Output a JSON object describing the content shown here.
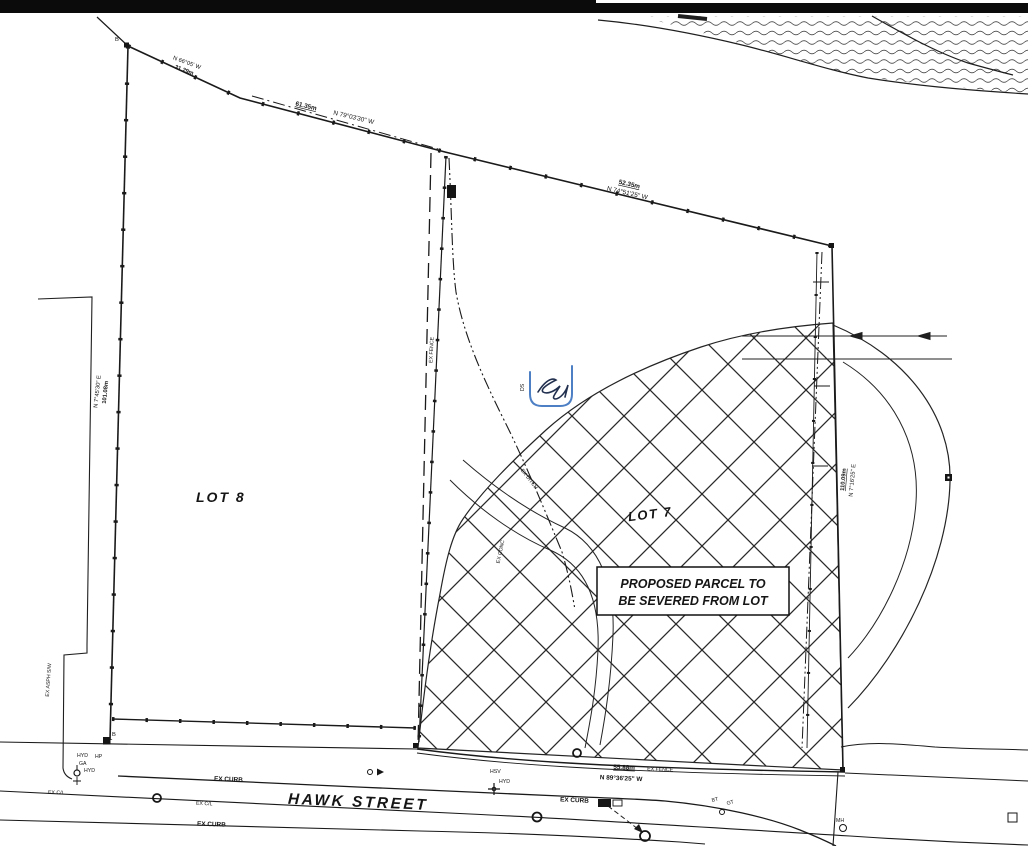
{
  "colors": {
    "ink": "#1b1b1b",
    "annotation_blue": "#4d7fc4"
  },
  "labels": {
    "lot8": "LOT 8",
    "lot7": "LOT 7",
    "parcel_note_1": "PROPOSED PARCEL TO",
    "parcel_note_2": "BE SEVERED FROM LOT",
    "street": "HAWK STREET",
    "ex_curb": "EX CURB",
    "ex_cl": "EX C/L",
    "ex_fence": "EX FENCE",
    "ex_asph_sw": "EX ASPH S/W",
    "ex_conc": "EX CONC",
    "ex_ditch": "EX DITCH",
    "hyd": "HYD",
    "hp": "HP",
    "ga": "GA",
    "hsv": "HSV",
    "mh": "MH",
    "bt": "BT",
    "gt": "GT",
    "ds": "DS",
    "b": "B"
  },
  "bearings": {
    "west": {
      "bearing": "N 7°45'30\" E",
      "distance": "101.08m"
    },
    "north_upper": {
      "bearing": "N 66°05' W",
      "distance": "31.29m"
    },
    "north_mid": {
      "bearing": "N 79°03'30\" W",
      "distance": "61.35m"
    },
    "north_lower": {
      "bearing": "N 74°51'25\" W",
      "distance": "52.35m"
    },
    "east": {
      "bearing": "N 7°16'25\" E",
      "distance": "110.09m"
    },
    "south": {
      "bearing": "N 89°36'25\" W",
      "distance": "55.88m"
    }
  }
}
